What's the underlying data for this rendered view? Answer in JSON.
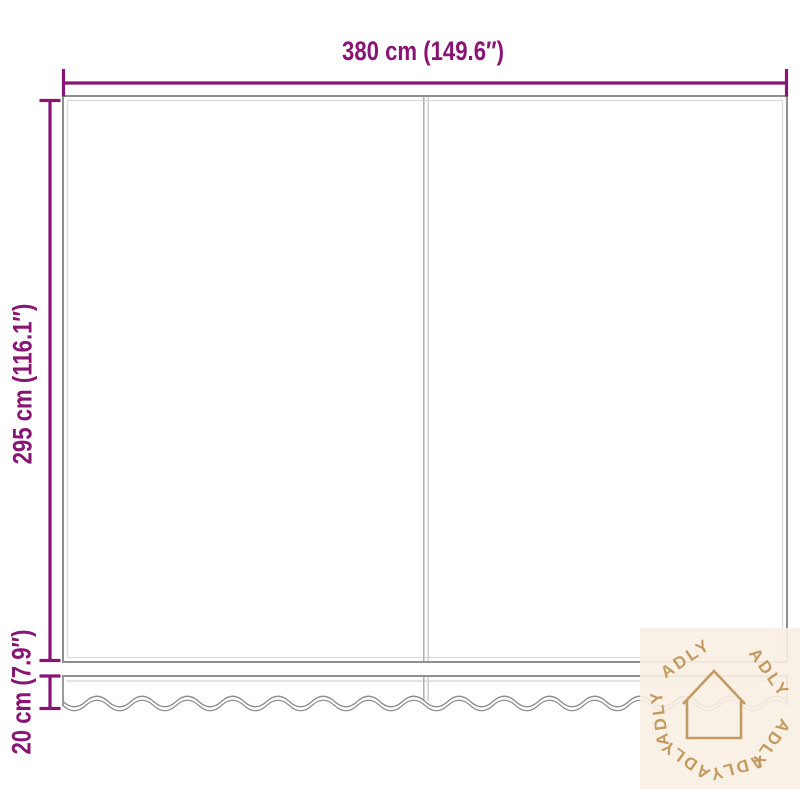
{
  "diagram": {
    "width_label": "380 cm (149.6″)",
    "height_label": "295 cm (116.1″)",
    "valance_label": "20 cm (7.9″)"
  },
  "watermark": {
    "brand": "ADLY"
  },
  "colors": {
    "dimension": "#8a1474",
    "outline": "#8f8f8f",
    "outline_light": "#dcdcdc",
    "watermark_bg": "#faf0e3",
    "watermark_fg": "#c39a60"
  }
}
